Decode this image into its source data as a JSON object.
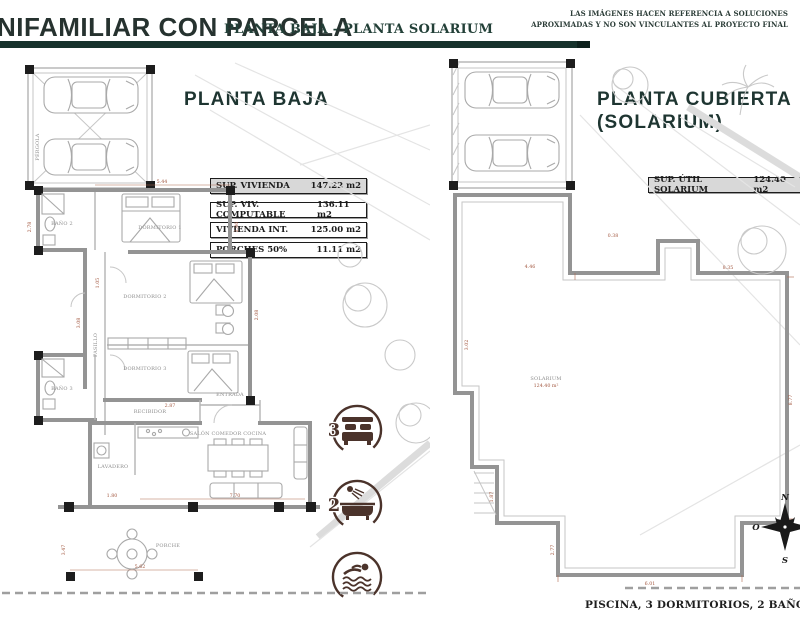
{
  "header": {
    "title": "NIFAMILIAR CON PARCELA",
    "subtitle": "PLANTA BAJA - PLANTA SOLARIUM",
    "disclaimer_line1": "LAS IMÁGENES HACEN REFERENCIA A SOLUCIONES",
    "disclaimer_line2": "APROXIMADAS Y NO SON VINCULANTES AL PROYECTO FINAL",
    "accent_color": "#16322c"
  },
  "planta_baja": {
    "title": "PLANTA BAJA",
    "surface_table": {
      "rows": [
        {
          "label": "SUP. VIVIENDA",
          "value": "147.22 m2"
        },
        {
          "label": "SUP. VIV. COMPUTABLE",
          "value": "136.11 m2"
        },
        {
          "label": "VIVIENDA INT.",
          "value": "125.00 m2"
        },
        {
          "label": "PORCHES 50%",
          "value": "11.11 m2"
        }
      ]
    },
    "rooms": {
      "pergola": "PÉRGOLA",
      "bano2": "BAÑO 2",
      "dormitorio1": "DORMITORIO 1",
      "dormitorio2": "DORMITORIO 2",
      "dormitorio3": "DORMITORIO 3",
      "pasillo": "PASILLO",
      "bano3": "BAÑO 3",
      "recibidor": "RECIBIDOR",
      "entrada": "ENTRADA",
      "lavadero": "LAVADERO",
      "salon": "SALÓN COMEDOR COCINA",
      "porche": "PORCHE"
    },
    "dims": [
      "5.44",
      "2.78",
      "2.06",
      "1.05",
      "3.08",
      "2.08",
      "7.70",
      "1.80",
      "2.87",
      "5.62",
      "3.47"
    ],
    "badges": {
      "bedrooms": "3",
      "bathrooms": "2"
    }
  },
  "planta_cubierta": {
    "title_line1": "PLANTA CUBIERTA",
    "title_line2": "(SOLARIUM)",
    "surface_label": "SUP. ÚTIL SOLARIUM",
    "surface_value": "124.40 m2",
    "room_label": "SOLARIUM",
    "room_area": "124.40 m²",
    "dims": [
      "0.38",
      "8.35",
      "3.02",
      "1.87",
      "8.77",
      "6.01",
      "4.46",
      "2.77"
    ],
    "compass": {
      "n": "N",
      "s": "S",
      "o": "O"
    }
  },
  "footer": {
    "features": "PISCINA, 3 DORMITORIOS, 2 BAÑOS"
  }
}
